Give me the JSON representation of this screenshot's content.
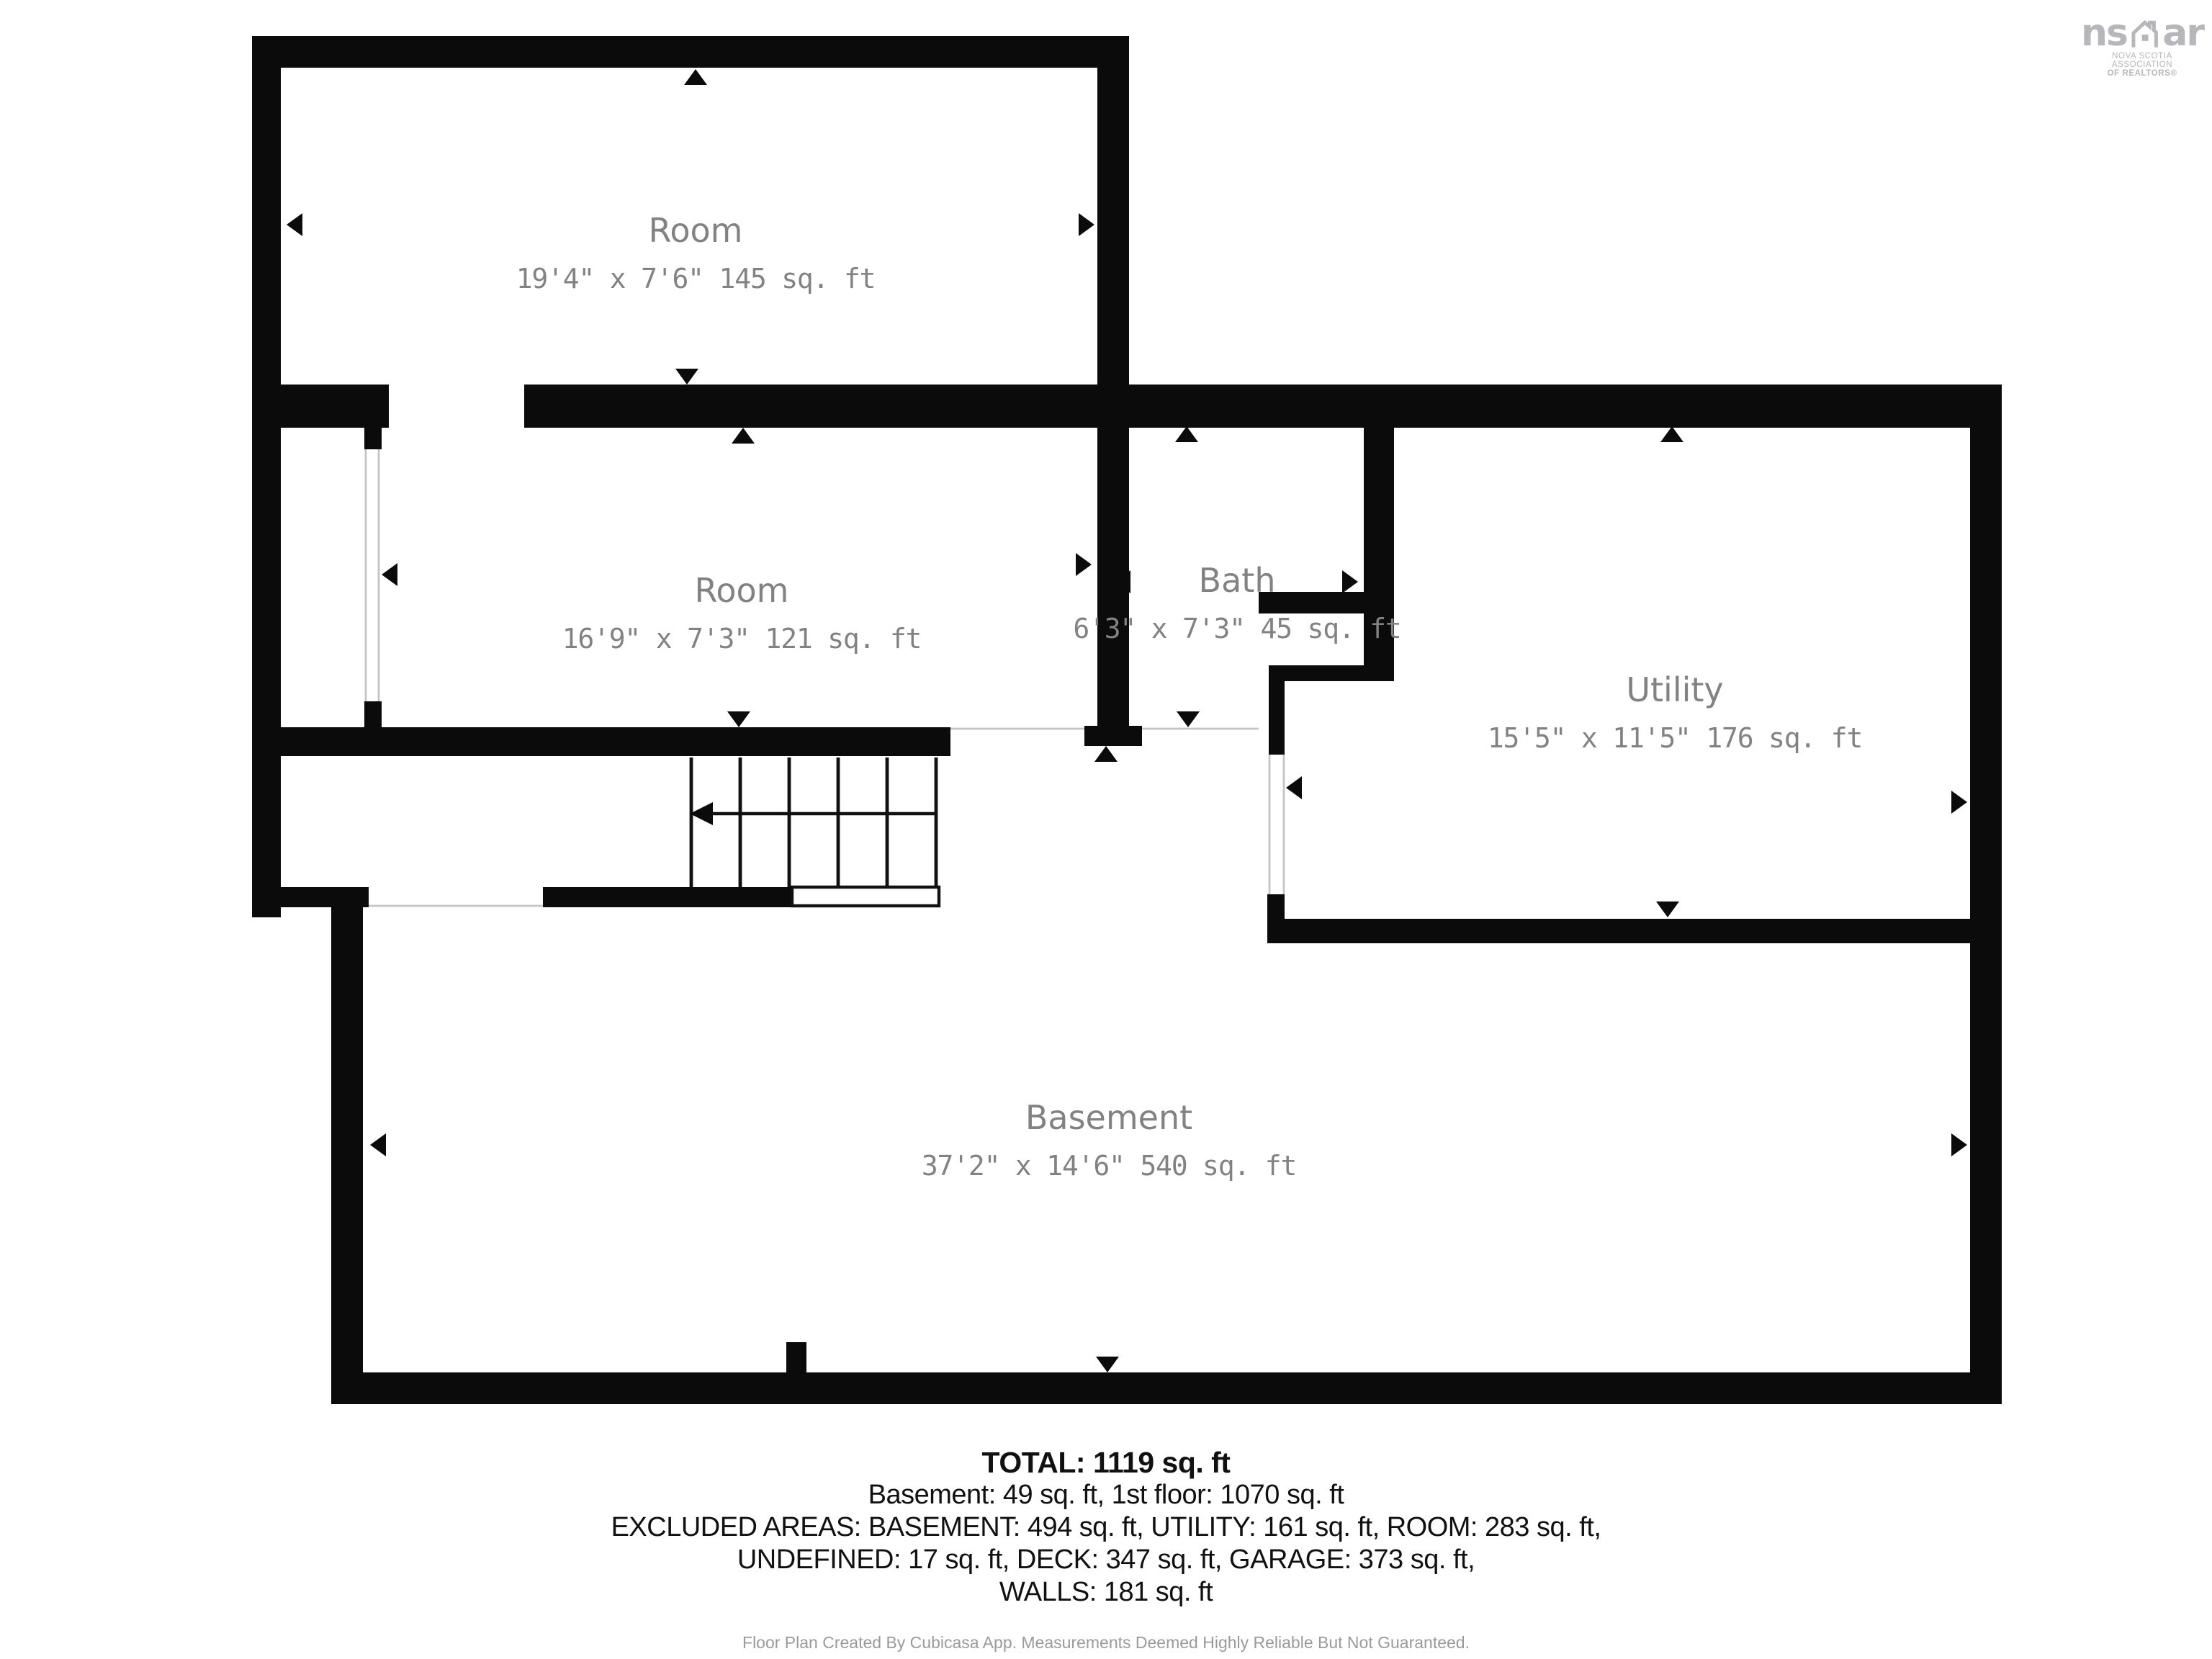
{
  "floorplan": {
    "colors": {
      "wall": "#0b0b0b",
      "room_label": "#828282"
    },
    "rooms": [
      {
        "name": "Room",
        "dims": "19'4\" x 7'6\" 145 sq. ft"
      },
      {
        "name": "Room",
        "dims": "16'9\" x 7'3\" 121 sq. ft"
      },
      {
        "name": "Bath",
        "dims": "6'3\" x 7'3\" 45 sq. ft"
      },
      {
        "name": "Utility",
        "dims": "15'5\" x 11'5\" 176 sq. ft"
      },
      {
        "name": "Basement",
        "dims": "37'2\" x 14'6\" 540 sq. ft"
      }
    ]
  },
  "summary": {
    "total": "TOTAL: 1119 sq. ft",
    "floors": "Basement: 49 sq. ft, 1st floor: 1070 sq. ft",
    "excluded_1": "EXCLUDED AREAS: BASEMENT: 494 sq. ft, UTILITY: 161 sq. ft, ROOM: 283 sq. ft,",
    "excluded_2": "UNDEFINED: 17 sq. ft, DECK: 347 sq. ft, GARAGE: 373 sq. ft,",
    "walls": "WALLS: 181 sq. ft"
  },
  "footer": {
    "disclaimer": "Floor Plan Created By Cubicasa App. Measurements Deemed Highly Reliable But Not Guaranteed."
  },
  "logo": {
    "mark_left": "ns",
    "mark_right": "ar",
    "org_line1": "NOVA SCOTIA ASSOCIATION",
    "org_line2": "OF REALTORS®",
    "color": "#b7b6ba"
  }
}
